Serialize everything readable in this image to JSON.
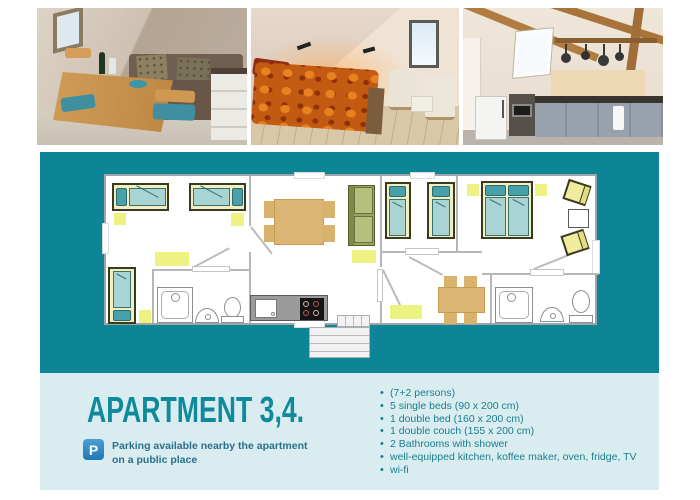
{
  "colors": {
    "accent_teal": "#0d8596",
    "panel_bg": "#d9edf1",
    "heading_text": "#0f8a9c",
    "list_text": "#1a7e8e",
    "parking_text": "#2b6e8c",
    "parking_icon_bg": "#2178b4",
    "highlight_yellow": "#eef283"
  },
  "details": {
    "title": "APARTMENT 3,4.",
    "parking_icon_letter": "P",
    "parking_note_line1": "Parking available nearby the apartment",
    "parking_note_line2": "on a public place",
    "features": [
      "(7+2 persons)",
      "5 single beds (90 x 200 cm)",
      "1 double bed (160 x 200 cm)",
      "1 double couch (155 x 200 cm)",
      "2 Bathrooms with shower",
      "well-equipped kitchen, koffee maker, oven, fridge, TV",
      "wi-fi"
    ]
  }
}
